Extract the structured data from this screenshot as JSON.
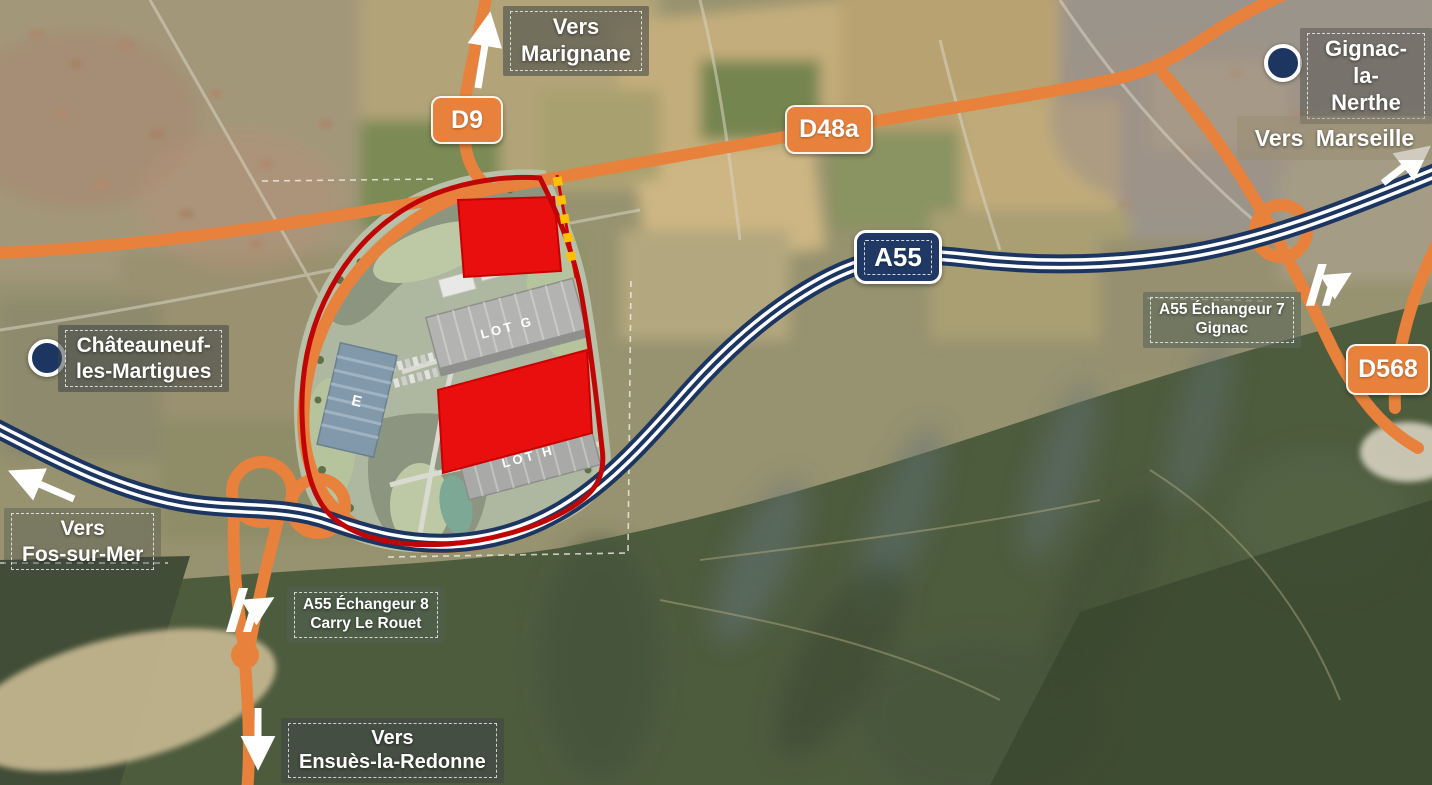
{
  "badges": {
    "d9": "D9",
    "d48a": "D48a",
    "a55": "A55",
    "d568": "D568"
  },
  "cities": {
    "gignac": {
      "line1": "Gignac-la-",
      "line2": "Nerthe"
    },
    "chateauneuf": {
      "line1": "Châteauneuf-",
      "line2": "les-Martigues"
    }
  },
  "directions": {
    "marignane": {
      "line1": "Vers",
      "line2": "Marignane"
    },
    "marseille": {
      "text": "Vers  Marseille"
    },
    "fos": {
      "line1": "Vers",
      "line2": "Fos-sur-Mer"
    },
    "ensues": {
      "line1": "Vers",
      "line2": "Ensuès-la-Redonne"
    }
  },
  "interchanges": {
    "e7": {
      "line1": "A55 Échangeur 7",
      "line2": "Gignac"
    },
    "e8": {
      "line1": "A55 Échangeur 8",
      "line2": "Carry Le Rouet"
    }
  },
  "site": {
    "lot_g": "LOT G",
    "lot_h": "LOT H",
    "building_e": "E"
  },
  "colors": {
    "road_orange": "#e8813b",
    "highway_navy": "#1d3661",
    "lot_red": "#e90f0f",
    "boundary_red": "#c00505",
    "gold_dash": "#ffc000",
    "label_text": "#ffffff"
  }
}
